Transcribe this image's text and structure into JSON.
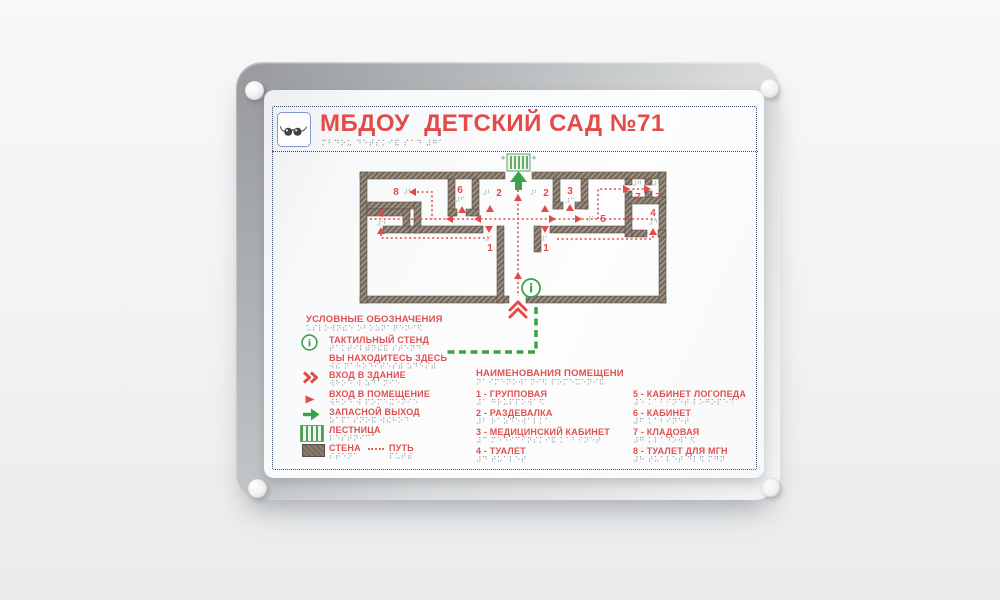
{
  "sign": {
    "title": {
      "text": "МБДОУ  ДЕТСКИЙ САД №71",
      "braille": "⠍⠃⠙⠕⠥ ⠙⠑⠞⠎⠅⠊⠯ ⠎⠁⠙ ⠼⠛⠁",
      "accent_color": "#e34b4b"
    },
    "plan": {
      "info_symbol": "i",
      "colors": {
        "wall": "#76685a",
        "route": "#e34b4b",
        "exit_green": "#3ba24a"
      },
      "labels": [
        {
          "text": "8",
          "braille": "⠼⠓",
          "x": 132,
          "y": 105,
          "bx": 144,
          "by": 104
        },
        {
          "text": "6",
          "braille": "⠼⠋",
          "x": 196,
          "y": 103,
          "bx": 196,
          "by": 112
        },
        {
          "text": "2",
          "braille": "⠼⠃",
          "x": 235,
          "y": 106,
          "bx": 223,
          "by": 105
        },
        {
          "text": "2",
          "braille": "⠼⠃",
          "x": 282,
          "y": 106,
          "bx": 270,
          "by": 105
        },
        {
          "text": "3",
          "braille": "⠼⠉",
          "x": 306,
          "y": 104,
          "bx": 306,
          "by": 113
        },
        {
          "text": "5",
          "braille": "⠼⠑",
          "x": 339,
          "y": 132,
          "bx": 327,
          "by": 131
        },
        {
          "text": "7",
          "braille": "⠼⠛",
          "x": 374,
          "y": 110,
          "bx": 373,
          "by": 96
        },
        {
          "text": "7",
          "braille": "⠼⠛",
          "x": 394,
          "y": 110,
          "bx": 393,
          "by": 96
        },
        {
          "text": "4",
          "braille": "⠼⠙",
          "x": 117,
          "y": 127,
          "bx": 117,
          "by": 136
        },
        {
          "text": "4",
          "braille": "⠼⠙",
          "x": 389,
          "y": 126,
          "bx": 389,
          "by": 135
        },
        {
          "text": "1",
          "braille": "⠼⠁",
          "x": 226,
          "y": 161,
          "bx": 225,
          "by": 151
        },
        {
          "text": "1",
          "braille": "⠼⠁",
          "x": 282,
          "y": 161,
          "bx": 281,
          "by": 151
        }
      ]
    },
    "legend": {
      "header": {
        "text": "УСЛОВНЫЕ ОБОЗНАЧЕНИЯ",
        "braille": "⠥⠎⠇⠕⠺⠝⠮⠑ ⠕⠃⠕⠵⠝⠁⠟⠑⠝⠊⠫"
      },
      "items": [
        {
          "icon": "info-circle",
          "text": "ТАКТИЛЬНЫЙ СТЕНД",
          "braille": "⠞⠁⠅⠞⠊⠇⠾⠝⠮⠯ ⠎⠞⠑⠝⠙"
        },
        {
          "icon": "you-are-here-line",
          "text": "ВЫ НАХОДИТЕСЬ ЗДЕСЬ",
          "braille": "⠺⠮ ⠝⠁⠓⠕⠙⠊⠞⠑⠎⠾ ⠵⠙⠑⠎⠾"
        },
        {
          "icon": "double-chevron-right",
          "text": "ВХОД В ЗДАНИЕ",
          "braille": "⠺⠓⠕⠙ ⠺ ⠵⠙⠁⠝⠊⠑"
        },
        {
          "icon": "triangle-right",
          "text": "ВХОД В ПОМЕЩЕНИЕ",
          "braille": "⠺⠓⠕⠙ ⠺ ⠏⠕⠍⠑⠭⠑⠝⠊⠑"
        },
        {
          "icon": "green-arrow-right",
          "text": "ЗАПАСНОЙ ВЫХОД",
          "braille": "⠵⠁⠏⠁⠎⠝⠕⠯ ⠺⠮⠓⠕⠙"
        },
        {
          "icon": "stairs-hatch",
          "text": "ЛЕСТНИЦА",
          "braille": "⠇⠑⠎⠞⠝⠊⠉⠁"
        },
        {
          "icon": "wall-swatch",
          "text": "СТЕНА",
          "braille": "⠎⠞⠑⠝⠁"
        },
        {
          "icon": "dashed-line",
          "text": "ПУТЬ",
          "braille": "⠏⠥⠞⠾"
        }
      ]
    },
    "rooms": {
      "header": {
        "text": "НАИМЕНОВАНИЯ ПОМЕЩЕНИ",
        "braille": "⠝⠁⠊⠍⠑⠝⠕⠺⠁⠝⠊⠫ ⠏⠕⠍⠑⠭⠑⠝⠊⠯"
      },
      "items": [
        {
          "label": "1 - ГРУППОВАЯ",
          "braille": "⠼⠁ ⠛⠗⠥⠏⠏⠕⠺⠁⠫"
        },
        {
          "label": "2 - РАЗДЕВАЛКА",
          "braille": "⠼⠃ ⠗⠁⠵⠙⠑⠺⠁⠇⠅⠁"
        },
        {
          "label": "3 - МЕДИЦИНСКИЙ КАБИНЕТ",
          "braille": "⠼⠉ ⠍⠑⠙⠊⠉⠊⠝⠎⠅⠊⠯ ⠅⠁⠃⠊⠝⠑⠞"
        },
        {
          "label": "4 - ТУАЛЕТ",
          "braille": "⠼⠙ ⠞⠥⠁⠇⠑⠞"
        },
        {
          "label": "5 - КАБИНЕТ ЛОГОПЕДА",
          "braille": "⠼⠑ ⠅⠁⠃⠊⠝⠑⠞ ⠇⠕⠛⠕⠏⠑⠙⠁"
        },
        {
          "label": "6 - КАБИНЕТ",
          "braille": "⠼⠋ ⠅⠁⠃⠊⠝⠑⠞"
        },
        {
          "label": "7 - КЛАДОВАЯ",
          "braille": "⠼⠛ ⠅⠇⠁⠙⠕⠺⠁⠫"
        },
        {
          "label": "8 - ТУАЛЕТ ДЛЯ МГН",
          "braille": "⠼⠓ ⠞⠥⠁⠇⠑⠞ ⠙⠇⠫ ⠍⠛⠝"
        }
      ]
    }
  }
}
